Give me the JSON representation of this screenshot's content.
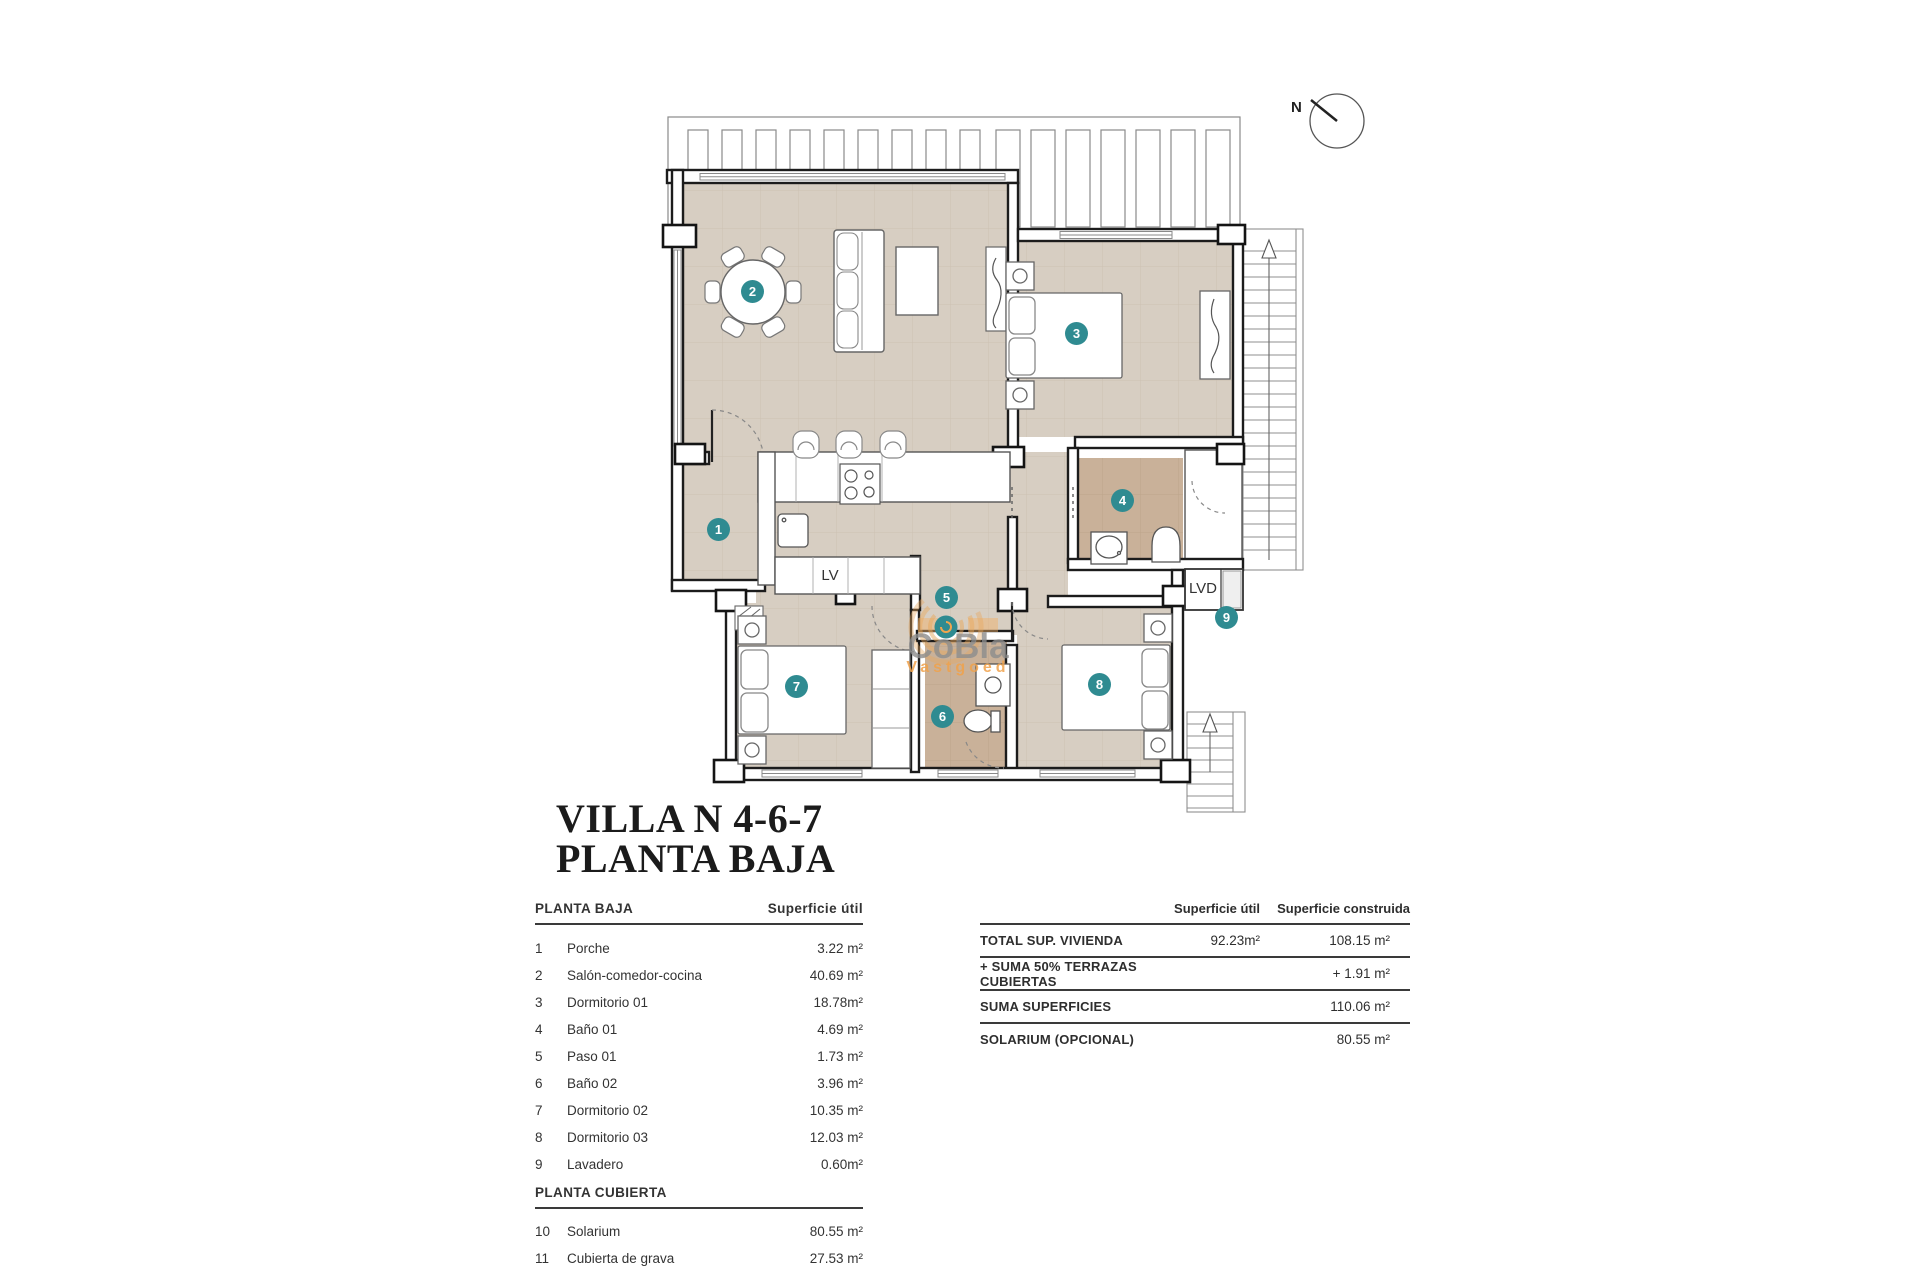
{
  "title": {
    "line1": "VILLA N 4-6-7",
    "line2": "PLANTA BAJA"
  },
  "plan": {
    "north_label": "N",
    "labels": {
      "dishwasher": "LV",
      "laundry": "LVD"
    },
    "colors": {
      "accent_teal": "#2f8b91",
      "floor_tan": "#d7cec2",
      "floor_wet": "#c9b199",
      "watermark_orange": "#f0a24b",
      "wall": "#1c1c1c"
    },
    "markers": [
      {
        "n": "1",
        "room": "Porche"
      },
      {
        "n": "2",
        "room": "Salón-comedor-cocina"
      },
      {
        "n": "3",
        "room": "Dormitorio 01"
      },
      {
        "n": "4",
        "room": "Baño 01"
      },
      {
        "n": "5",
        "room": "Paso 01"
      },
      {
        "n": "6",
        "room": "Baño 02"
      },
      {
        "n": "7",
        "room": "Dormitorio 02"
      },
      {
        "n": "8",
        "room": "Dormitorio 03"
      },
      {
        "n": "9",
        "room": "Lavadero"
      }
    ]
  },
  "watermark": {
    "name": "CoBla",
    "tagline": "Vastgoed"
  },
  "surface_table": {
    "section_ground": {
      "header": "PLANTA BAJA",
      "column_header": "Superficie útil",
      "rows": [
        {
          "num": "1",
          "name": "Porche",
          "area": "3.22 m²"
        },
        {
          "num": "2",
          "name": "Salón-comedor-cocina",
          "area": "40.69 m²"
        },
        {
          "num": "3",
          "name": "Dormitorio 01",
          "area": "18.78m²"
        },
        {
          "num": "4",
          "name": "Baño 01",
          "area": "4.69 m²"
        },
        {
          "num": "5",
          "name": "Paso 01",
          "area": "1.73 m²"
        },
        {
          "num": "6",
          "name": "Baño 02",
          "area": "3.96 m²"
        },
        {
          "num": "7",
          "name": "Dormitorio 02",
          "area": "10.35 m²"
        },
        {
          "num": "8",
          "name": "Dormitorio 03",
          "area": "12.03 m²"
        },
        {
          "num": "9",
          "name": "Lavadero",
          "area": "0.60m²"
        }
      ]
    },
    "section_roof": {
      "header": "PLANTA CUBIERTA",
      "rows": [
        {
          "num": "10",
          "name": "Solarium",
          "area": "80.55 m²"
        },
        {
          "num": "11",
          "name": "Cubierta de grava",
          "area": "27.53 m²"
        }
      ]
    }
  },
  "totals_table": {
    "col_util": "Superficie útil",
    "col_built": "Superficie construida",
    "rows": [
      {
        "label": "TOTAL SUP. VIVIENDA",
        "util": "92.23m²",
        "built": "108.15 m²"
      },
      {
        "label": "+ SUMA 50% TERRAZAS CUBIERTAS",
        "util": "",
        "built": "+ 1.91 m²"
      },
      {
        "label": "SUMA SUPERFICIES",
        "util": "",
        "built": "110.06 m²"
      },
      {
        "label": "SOLARIUM (OPCIONAL)",
        "util": "",
        "built": "80.55 m²"
      }
    ]
  }
}
